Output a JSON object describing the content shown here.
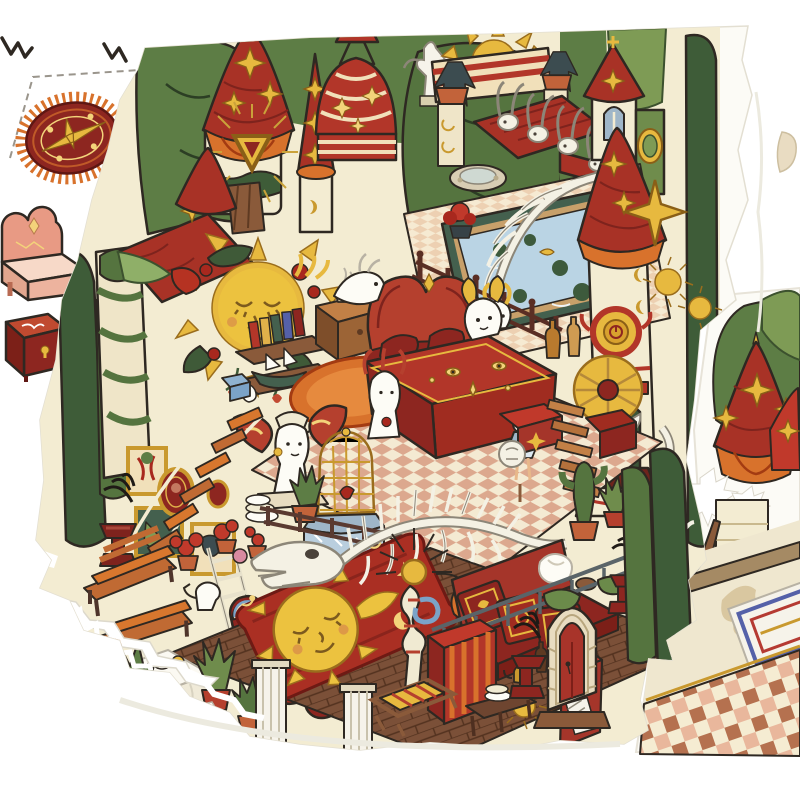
{
  "meta": {
    "description": "Photograph of an illustrated paper-craft spread: a die-cut isometric cutaway of a whimsical red-and-cream castle dollhouse laid over white sheets, with punch-out furniture pieces on the left sheet and a second illustrated sheet peeking out on the right.",
    "style": "hand-drawn cartoon illustration, red/gold/green palette, no visible text"
  },
  "palette": {
    "paper_white": "#ffffff",
    "page_offwhite": "#fcfbf6",
    "wall_cream": "#f3ecd2",
    "cream_stripe": "#f1e0ba",
    "deep_red": "#a83226",
    "bright_red": "#b23629",
    "dark_maroon": "#8d2620",
    "maroon_shadow": "#6e1a14",
    "orange": "#d8722c",
    "amber": "#c9992e",
    "gold": "#e7b93f",
    "sun_gold": "#ecc23f",
    "pale_gold": "#f3d37a",
    "leaf_dark": "#5d7d45",
    "leaf_light": "#7e9b55",
    "olive": "#6b8a4a",
    "cypress": "#3e5c38",
    "pool_blue": "#bad4e4",
    "pool_rim": "#44604e",
    "sky_blue": "#7ba3c8",
    "bone_white": "#f4f1e4",
    "bone_line": "#8c8678",
    "wood_brown": "#8a5a3a",
    "plank_orange": "#c06a33",
    "floor_brown": "#7b5038",
    "floor_line": "#53321f",
    "railing_dark": "#46342c",
    "metal_gray": "#5a6468",
    "checker_pink": "#dca88e",
    "terracotta": "#c2633a",
    "beige_floor": "#efe7cf",
    "shadow_beige": "#d9c7a0",
    "tile_brown": "#b5714f",
    "tile_peach": "#e9b79c",
    "bed_pink": "#e89a84",
    "mattress_pink": "#f7d9c8",
    "ink_outline": "#2e2822",
    "dash_gray": "#9a958c"
  },
  "left_sheet": {
    "label": "White backing sheet with punch-out furniture pieces and dashed cut lines",
    "pieces": [
      {
        "name": "crop-marks",
        "label": "Black zigzag print marks at top edge"
      },
      {
        "name": "dashed-cut-line",
        "label": "Gray dashed die-cut outline"
      },
      {
        "name": "oval-rug-piece",
        "label": "Oval maroon rug cut-out with orange fringe and gold compass star"
      },
      {
        "name": "pink-bed-piece",
        "label": "Pink scalloped-headboard bed cut-out"
      },
      {
        "name": "red-chest-piece",
        "label": "Deep red storage chest cut-out with gold keyhole"
      }
    ]
  },
  "main_piece": {
    "label": "Die-cut castle cutaway illustration with torn white edges",
    "elements": [
      {
        "name": "tree-canopy",
        "label": "Dark green leafy trees behind the castle"
      },
      {
        "name": "left-star-tower",
        "label": "White tower with red conical roof, gold four-point stars and glowing gold triangle amulet"
      },
      {
        "name": "red-spire",
        "label": "Narrow red spire with chain of gold stars"
      },
      {
        "name": "striped-dome",
        "label": "Red dome with cream stripes, gold sparkles and rooftop lantern"
      },
      {
        "name": "sun-ornament",
        "label": "Radiant gold sun rising behind a red-striped parapet"
      },
      {
        "name": "angel-statue",
        "label": "White winged statue beside the dome"
      },
      {
        "name": "skull-roof",
        "label": "Red shingled roof ridge lined with horned animal skulls"
      },
      {
        "name": "church-tower",
        "label": "Chapel tower with blue gothic window, red cone and green side turret"
      },
      {
        "name": "great-tower",
        "label": "Tall white tower: red star-topped cone, gold medallion clock, angel niche and bone spiral column"
      },
      {
        "name": "roof-terrace",
        "label": "Rooftop terrace with blue lily pond, arched fish skeleton, railing and bottles"
      },
      {
        "name": "sun-mural",
        "label": "Gold sleeping-sun mural wreathed in leaves and red roses"
      },
      {
        "name": "bedroom",
        "label": "Red canopy bed with gold-eye quilt on checkered floor, nightstand and gramophone"
      },
      {
        "name": "butterfly-busts",
        "label": "White busts with butterfly wings, gold birdcage on blue table"
      },
      {
        "name": "paintings-wall",
        "label": "Gallery wall of gold-framed paintings with rope-plank stairs and ladder"
      },
      {
        "name": "garden-benches",
        "label": "Wooden slat benches with potted red geraniums and watering can"
      },
      {
        "name": "folding-screens",
        "label": "Three arched red folding-screen panels with gold stars"
      },
      {
        "name": "dragon-skeleton",
        "label": "Long white dragon skeleton suspended over the lower hall"
      },
      {
        "name": "sun-rug",
        "label": "Flame-edged red rug with large gold sleeping sun face"
      },
      {
        "name": "red-sofa",
        "label": "Red sofa with three ornate gold-patterned cushions"
      },
      {
        "name": "striped-cabinet",
        "label": "Red cabinet with orange stripes, deck chair and brass kettle table"
      },
      {
        "name": "gothic-door",
        "label": "Stone gothic arch with red door, flanked by dark candle pedestals with black plumes"
      },
      {
        "name": "cypress-trees",
        "label": "Tall dark cypress trees at the right edge"
      },
      {
        "name": "torn-edges",
        "label": "White torn paper streaks across the lower-left edge"
      }
    ]
  },
  "right_sheet": {
    "label": "Second illustrated sheet underneath, right side",
    "elements": [
      {
        "name": "right-star-roofs",
        "label": "Red conical roofs with gold stars and white snow bursts among trees"
      },
      {
        "name": "beige-floor",
        "label": "Beige floor with painted leaf shadows and wooden beam"
      },
      {
        "name": "ornate-rug",
        "label": "Corner of a white rug with blue and red ornament"
      },
      {
        "name": "tile-border",
        "label": "Brown, peach and cream checkered tile border"
      }
    ]
  }
}
